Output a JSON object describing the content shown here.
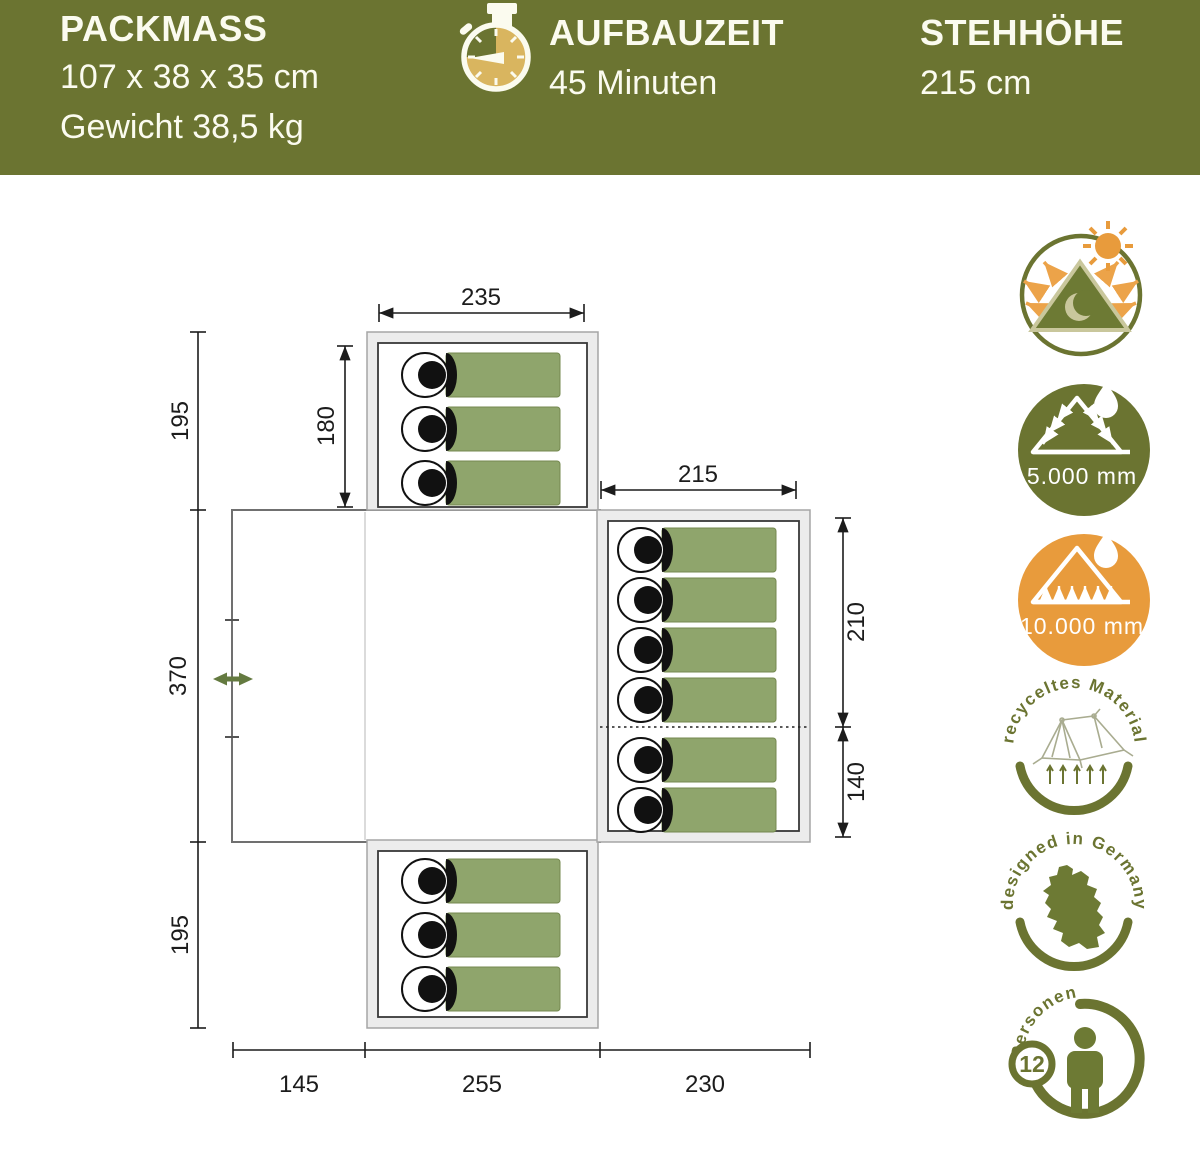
{
  "header": {
    "bg_color": "#6b7431",
    "text_color": "#fbfbef",
    "packmass": {
      "title": "PACKMASS",
      "dimensions": "107 x 38 x 35 cm",
      "weight": "Gewicht 38,5 kg"
    },
    "aufbauzeit": {
      "title": "AUFBAUZEIT",
      "value": "45 Minuten",
      "icon": "stopwatch-icon"
    },
    "stehhoehe": {
      "title": "STEHHÖHE",
      "value": "215 cm"
    }
  },
  "floorplan": {
    "unit": "cm",
    "dims": {
      "top_cabin_width": "235",
      "top_cabin_depth": "180",
      "top_cabin_height": "195",
      "right_cabin_width": "215",
      "right_cabin_upper": "210",
      "right_cabin_lower": "140",
      "main_depth": "370",
      "bottom_cabin_height": "195",
      "bottom_left": "145",
      "bottom_middle": "255",
      "bottom_right": "230"
    },
    "sleeping_bags": {
      "top_cabin": 3,
      "right_cabin_upper": 4,
      "right_cabin_lower": 2,
      "bottom_cabin": 3
    },
    "colors": {
      "sleeping_bag": "#8fa56c",
      "wall_fill": "#ececec",
      "door_arrow": "#647a40"
    }
  },
  "badges": {
    "climate": {
      "icon": "sun-moon-tent-icon"
    },
    "flysheet": {
      "icon": "waterproof-flysheet-icon",
      "value": "5.000 mm"
    },
    "groundsheet": {
      "icon": "waterproof-floor-icon",
      "value": "10.000 mm"
    },
    "recycled": {
      "icon": "recycled-tent-icon",
      "label": "recyceltes Material"
    },
    "design": {
      "icon": "germany-map-icon",
      "label": "designed in Germany"
    },
    "capacity": {
      "icon": "person-icon",
      "label": "Personen",
      "value": "12"
    }
  },
  "colors": {
    "olive": "#6b7431",
    "orange": "#e89b3c",
    "gold": "#d9b55f",
    "khaki": "#c9c79c"
  }
}
